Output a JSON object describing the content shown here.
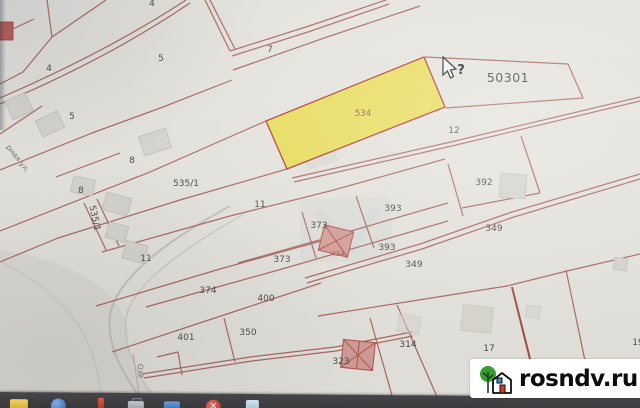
{
  "map": {
    "quarter_label": "50301",
    "cursor_query": "?",
    "highlighted_parcel": {
      "number": "534"
    },
    "building_numbers": [
      {
        "number": "434"
      }
    ],
    "parcel_labels": [
      {
        "number": "4"
      },
      {
        "number": "5"
      },
      {
        "number": "7"
      },
      {
        "number": "4"
      },
      {
        "number": "5"
      },
      {
        "number": "8"
      },
      {
        "number": "535/1"
      },
      {
        "number": "8"
      },
      {
        "number": "535/1"
      },
      {
        "number": "11"
      },
      {
        "number": "12"
      },
      {
        "number": "392"
      },
      {
        "number": "393"
      },
      {
        "number": "373"
      },
      {
        "number": "349"
      },
      {
        "number": "11"
      },
      {
        "number": "373"
      },
      {
        "number": "393"
      },
      {
        "number": "349"
      },
      {
        "number": "374"
      },
      {
        "number": "400"
      },
      {
        "number": "350"
      },
      {
        "number": "401"
      },
      {
        "number": "323"
      },
      {
        "number": "314"
      },
      {
        "number": "17"
      },
      {
        "number": "19"
      }
    ],
    "street_labels": [
      {
        "name": "рная ул."
      },
      {
        "name": "Озё"
      }
    ],
    "colors": {
      "boundary_line": "#b4685f",
      "highlight_fill": "#f1e44f",
      "highlight_border": "#c2342c",
      "paper": "#ebe9e2",
      "taskbar": "#3e3e41"
    }
  },
  "watermark": {
    "text": "rosndv.ru"
  },
  "taskbar": {
    "icons": [
      {
        "name": "folder-icon"
      },
      {
        "name": "browser-icon"
      },
      {
        "name": "bookmark-icon"
      },
      {
        "name": "briefcase-icon"
      },
      {
        "name": "mail-icon"
      },
      {
        "name": "close-badge-icon"
      },
      {
        "name": "document-icon"
      }
    ]
  }
}
